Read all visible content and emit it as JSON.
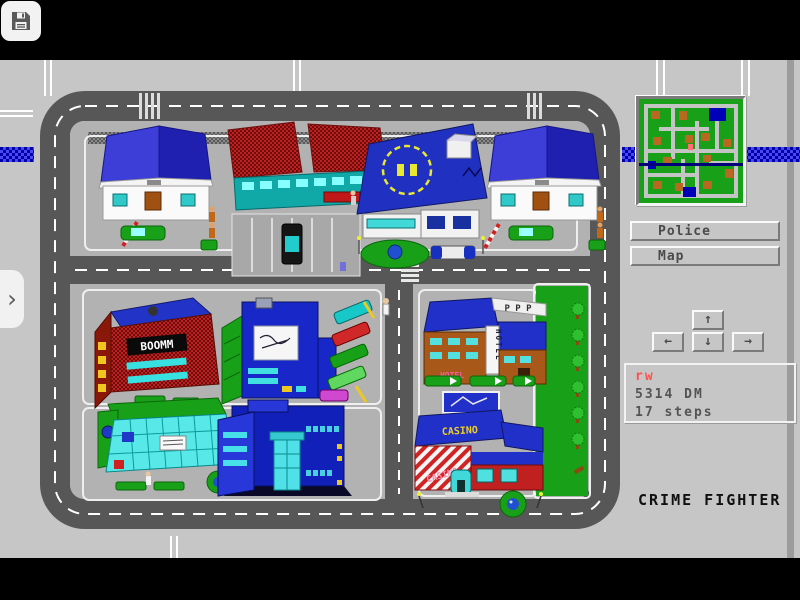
{
  "toolbar": {
    "save_tooltip": "Save"
  },
  "sidebar": {
    "buttons": [
      {
        "label": "Police"
      },
      {
        "label": "Map"
      }
    ],
    "dpad": {
      "up": "↑",
      "left": "←",
      "down": "↓",
      "right": "→"
    },
    "status": {
      "player": "rw",
      "money": "5314 DM",
      "steps": "17 steps"
    },
    "title": "CRIME FIGHTER"
  },
  "map": {
    "signs": {
      "department_store": "BOOMM",
      "hotel_vertical": "HOTEL",
      "hotel_side": "HOTEL",
      "parking_roof": "P P P",
      "casino_band": "CASINO",
      "casino_wall": "CASINO"
    },
    "buildings": [
      "house-nw",
      "shop",
      "police-station",
      "house-ne",
      "department-store",
      "office-tower",
      "hotel",
      "park",
      "mall",
      "nightclub",
      "casino"
    ]
  },
  "colors": {
    "bezel": "#c6c6c6",
    "road": "#575757",
    "stripe": "#0000aa",
    "minimap_ground": "#18a018",
    "minimap_building": "#b86820",
    "accent_blue": "#2030c8",
    "status_red": "#ff5050"
  }
}
